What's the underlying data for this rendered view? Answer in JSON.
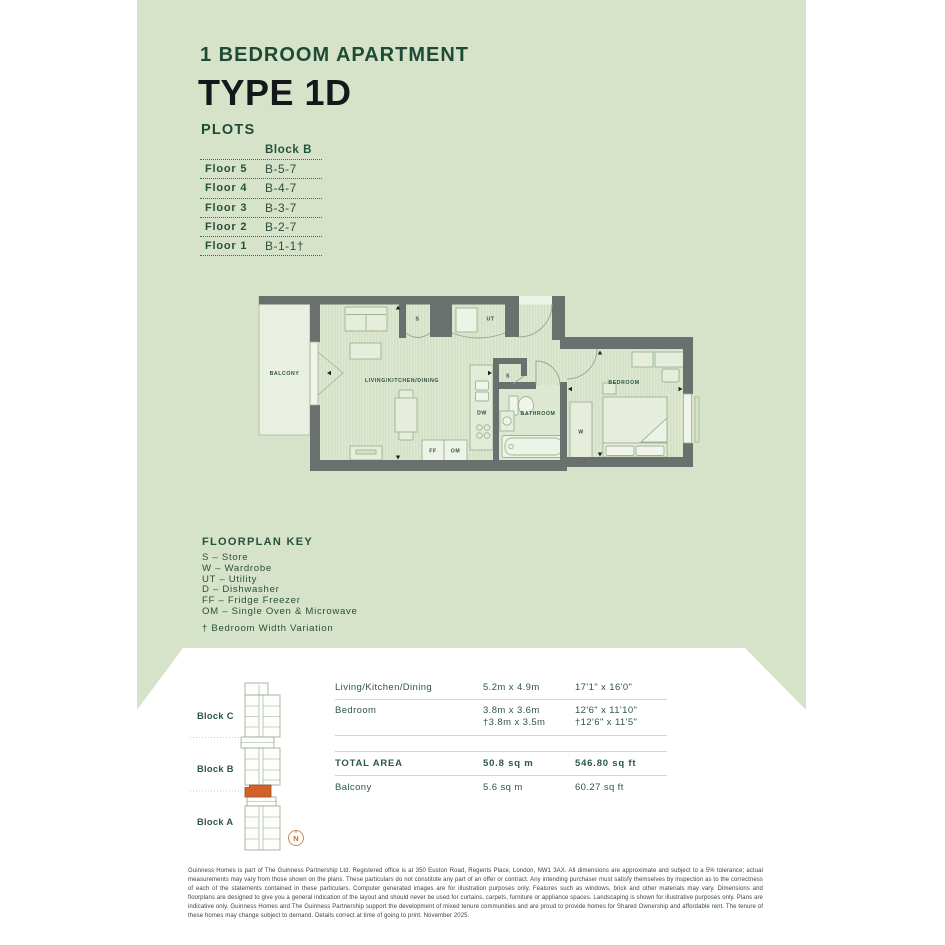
{
  "page": {
    "subtitle": "1 BEDROOM APARTMENT",
    "title": "TYPE 1D",
    "plots_heading": "PLOTS"
  },
  "plots_table": {
    "column_header": "Block B",
    "rows": [
      {
        "floor": "Floor 5",
        "plot": "B-5-7"
      },
      {
        "floor": "Floor 4",
        "plot": "B-4-7"
      },
      {
        "floor": "Floor 3",
        "plot": "B-3-7"
      },
      {
        "floor": "Floor 2",
        "plot": "B-2-7"
      },
      {
        "floor": "Floor 1",
        "plot": "B-1-1†"
      }
    ]
  },
  "floorplan": {
    "labels": {
      "balcony": "BALCONY",
      "living": "LIVING/KITCHEN/DINING",
      "bedroom": "BEDROOM",
      "bathroom": "BATHROOM",
      "store_top": "S",
      "store_mid": "S",
      "utility": "UT",
      "dishwasher": "DW",
      "fridge_freezer": "FF",
      "oven_microwave": "OM",
      "wardrobe": "W"
    }
  },
  "floorplan_key": {
    "title": "FLOORPLAN KEY",
    "items": [
      "S – Store",
      "W – Wardrobe",
      "UT – Utility",
      "D – Dishwasher",
      "FF – Fridge Freezer",
      "OM – Single Oven & Microwave"
    ],
    "note": "† Bedroom Width Variation"
  },
  "site_plan": {
    "block_labels": [
      "Block C",
      "Block B",
      "Block A"
    ],
    "compass": "N"
  },
  "dimensions_table": {
    "rows": [
      {
        "name": "Living/Kitchen/Dining",
        "metric": "5.2m x 4.9m",
        "imperial": "17'1\" x 16'0\""
      },
      {
        "name": "Bedroom",
        "metric": "3.8m x 3.6m",
        "metric2": "†3.8m x 3.5m",
        "imperial": "12'6\" x 11'10\"",
        "imperial2": "†12'6\" x 11'5\""
      }
    ],
    "total": {
      "name": "TOTAL AREA",
      "metric": "50.8 sq m",
      "imperial": "546.80 sq ft"
    },
    "balcony": {
      "name": "Balcony",
      "metric": "5.6 sq m",
      "imperial": "60.27 sq ft"
    }
  },
  "disclaimer": "Guinness Homes is part of The Guinness Partnership Ltd. Registered office is at 350 Euston Road, Regents Place, London, NW1 3AX. All dimensions are approximate and subject to a 5% tolerance; actual measurements may vary from those shown on the plans. These particulars do not constitute any part of an offer or contract. Any intending purchaser must satisfy themselves by inspection as to the correctness of each of the statements contained in these particulars. Computer generated images are for illustration purposes only. Features such as windows, brick and other materials may vary. Dimensions and floorplans are designed to give you a general indication of the layout and should never be used for curtains, carpets, furniture or appliance spaces. Landscaping is shown for illustrative purposes only. Plans are indicative only. Guinness Homes and The Guinness Partnership support the development of mixed tenure communities and are proud to provide homes for Shared Ownership and affordable rent. The tenure of these homes may change subject to demand. Details correct at time of going to print. November 2025.",
  "colors": {
    "background_green": "#d7e3c9",
    "dark_green_text": "#1d4b33",
    "title_black": "#15181a",
    "wall_gray": "#6a706e",
    "floor_base": "#dee8d3",
    "floor_stripe": "#d3e0c4",
    "highlight_orange": "#d2622a",
    "divider_tan": "#f2cda6"
  }
}
